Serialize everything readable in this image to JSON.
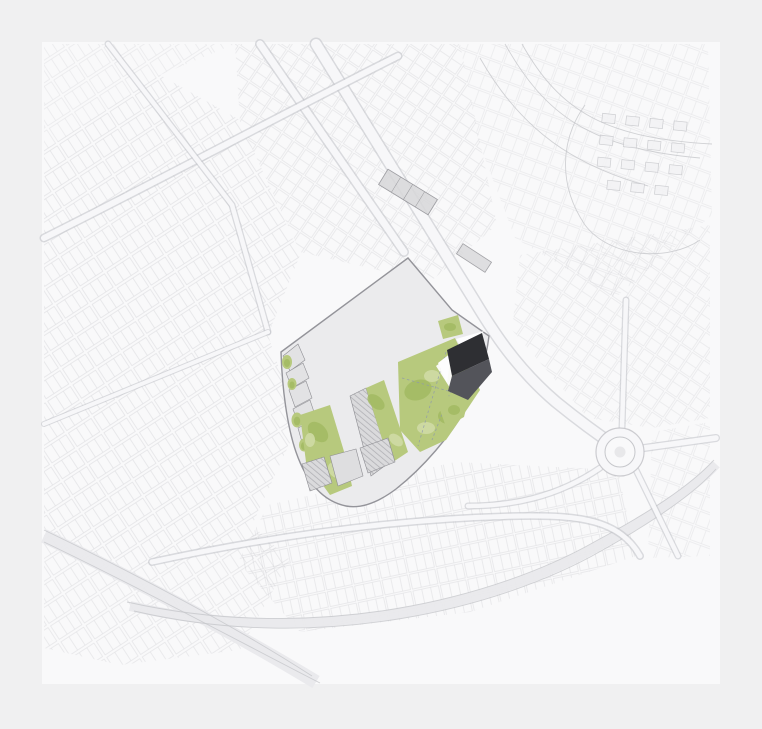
{
  "image": {
    "kind": "architectural-masterplan-site-plan",
    "width": 762,
    "height": 729,
    "visible_text": "none"
  },
  "palette": {
    "bg": "#f0f0f1",
    "mapbg": "#f9f9fa",
    "ctx": "#c6c7cb",
    "roadfill": "#f7f7f9",
    "roadcase": "#c0c1c6",
    "paleband": "#e9e9ec",
    "siteground": "#ebebed",
    "siteoutline": "#94949a",
    "bfill": "#d8d8da",
    "bstroke": "#8e8e93",
    "hatch": "#a4a4a9",
    "greenbase": "#b7c97d",
    "greendark": "#a2ba62",
    "greenlight": "#cfdaa5",
    "darktop": "#2e2f33",
    "darkbottom": "#53545a",
    "plaza": "#fdfdfe",
    "dash": "#8f9aab",
    "blockfill": "#f3f3f5",
    "winfill": "#1d1d20",
    "sideblock": "#e2e2e4"
  },
  "features": {
    "context": [
      "city-block-fabric",
      "main-avenue",
      "secondary-avenue",
      "roundabout",
      "railway-corridor",
      "highway-ramps",
      "small-block-cluster"
    ],
    "site": [
      "fan-shaped-site-outline",
      "sawtooth-roof-sheds",
      "large-central-hall",
      "green-corridors",
      "mottled-green-park",
      "dashed-footpaths",
      "pavilions-with-windows",
      "sports-pitch",
      "dark-new-building",
      "white-plaza-triangles",
      "perimeter-blocks"
    ]
  }
}
